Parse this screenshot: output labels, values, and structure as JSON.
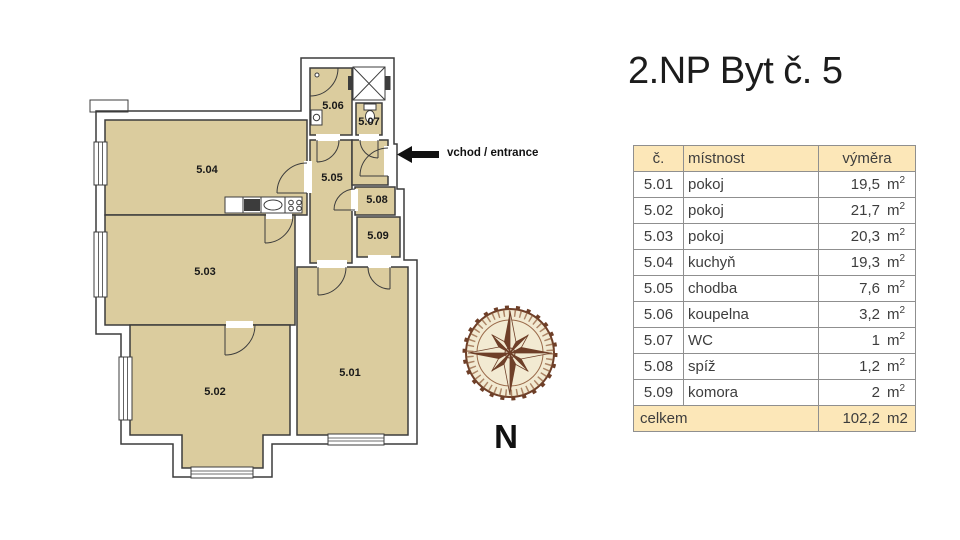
{
  "title": "2.NP Byt č. 5",
  "plan": {
    "room_labels": [
      "5.01",
      "5.02",
      "5.03",
      "5.04",
      "5.05",
      "5.06",
      "5.07",
      "5.08",
      "5.09"
    ],
    "entrance_label": "vchod / entrance",
    "compass_label": "N"
  },
  "table": {
    "headers": {
      "num": "č.",
      "room": "místnost",
      "area": "výměra"
    },
    "rows": [
      {
        "num": "5.01",
        "room": "pokoj",
        "area": "19,5",
        "unit": "m",
        "sup": "2"
      },
      {
        "num": "5.02",
        "room": "pokoj",
        "area": "21,7",
        "unit": "m",
        "sup": "2"
      },
      {
        "num": "5.03",
        "room": "pokoj",
        "area": "20,3",
        "unit": "m",
        "sup": "2"
      },
      {
        "num": "5.04",
        "room": "kuchyň",
        "area": "19,3",
        "unit": "m",
        "sup": "2"
      },
      {
        "num": "5.05",
        "room": "chodba",
        "area": "7,6",
        "unit": "m",
        "sup": "2"
      },
      {
        "num": "5.06",
        "room": "koupelna",
        "area": "3,2",
        "unit": "m",
        "sup": "2"
      },
      {
        "num": "5.07",
        "room": "WC",
        "area": "1",
        "unit": "m",
        "sup": "2"
      },
      {
        "num": "5.08",
        "room": "spíž",
        "area": "1,2",
        "unit": "m",
        "sup": "2"
      },
      {
        "num": "5.09",
        "room": "komora",
        "area": "2",
        "unit": "m",
        "sup": "2"
      }
    ],
    "footer": {
      "label": "celkem",
      "area": "102,2",
      "unit": "m2"
    }
  },
  "colors": {
    "room_fill": "#dbcc9e",
    "wall": "#3c3c3c",
    "table_header_fill": "#fce7b8",
    "table_grid": "#8f8f8f",
    "text": "#3d3d3d",
    "compass_dark": "#6e3f28",
    "compass_mid": "#9a6a4a",
    "compass_cream": "#f2ead2"
  }
}
